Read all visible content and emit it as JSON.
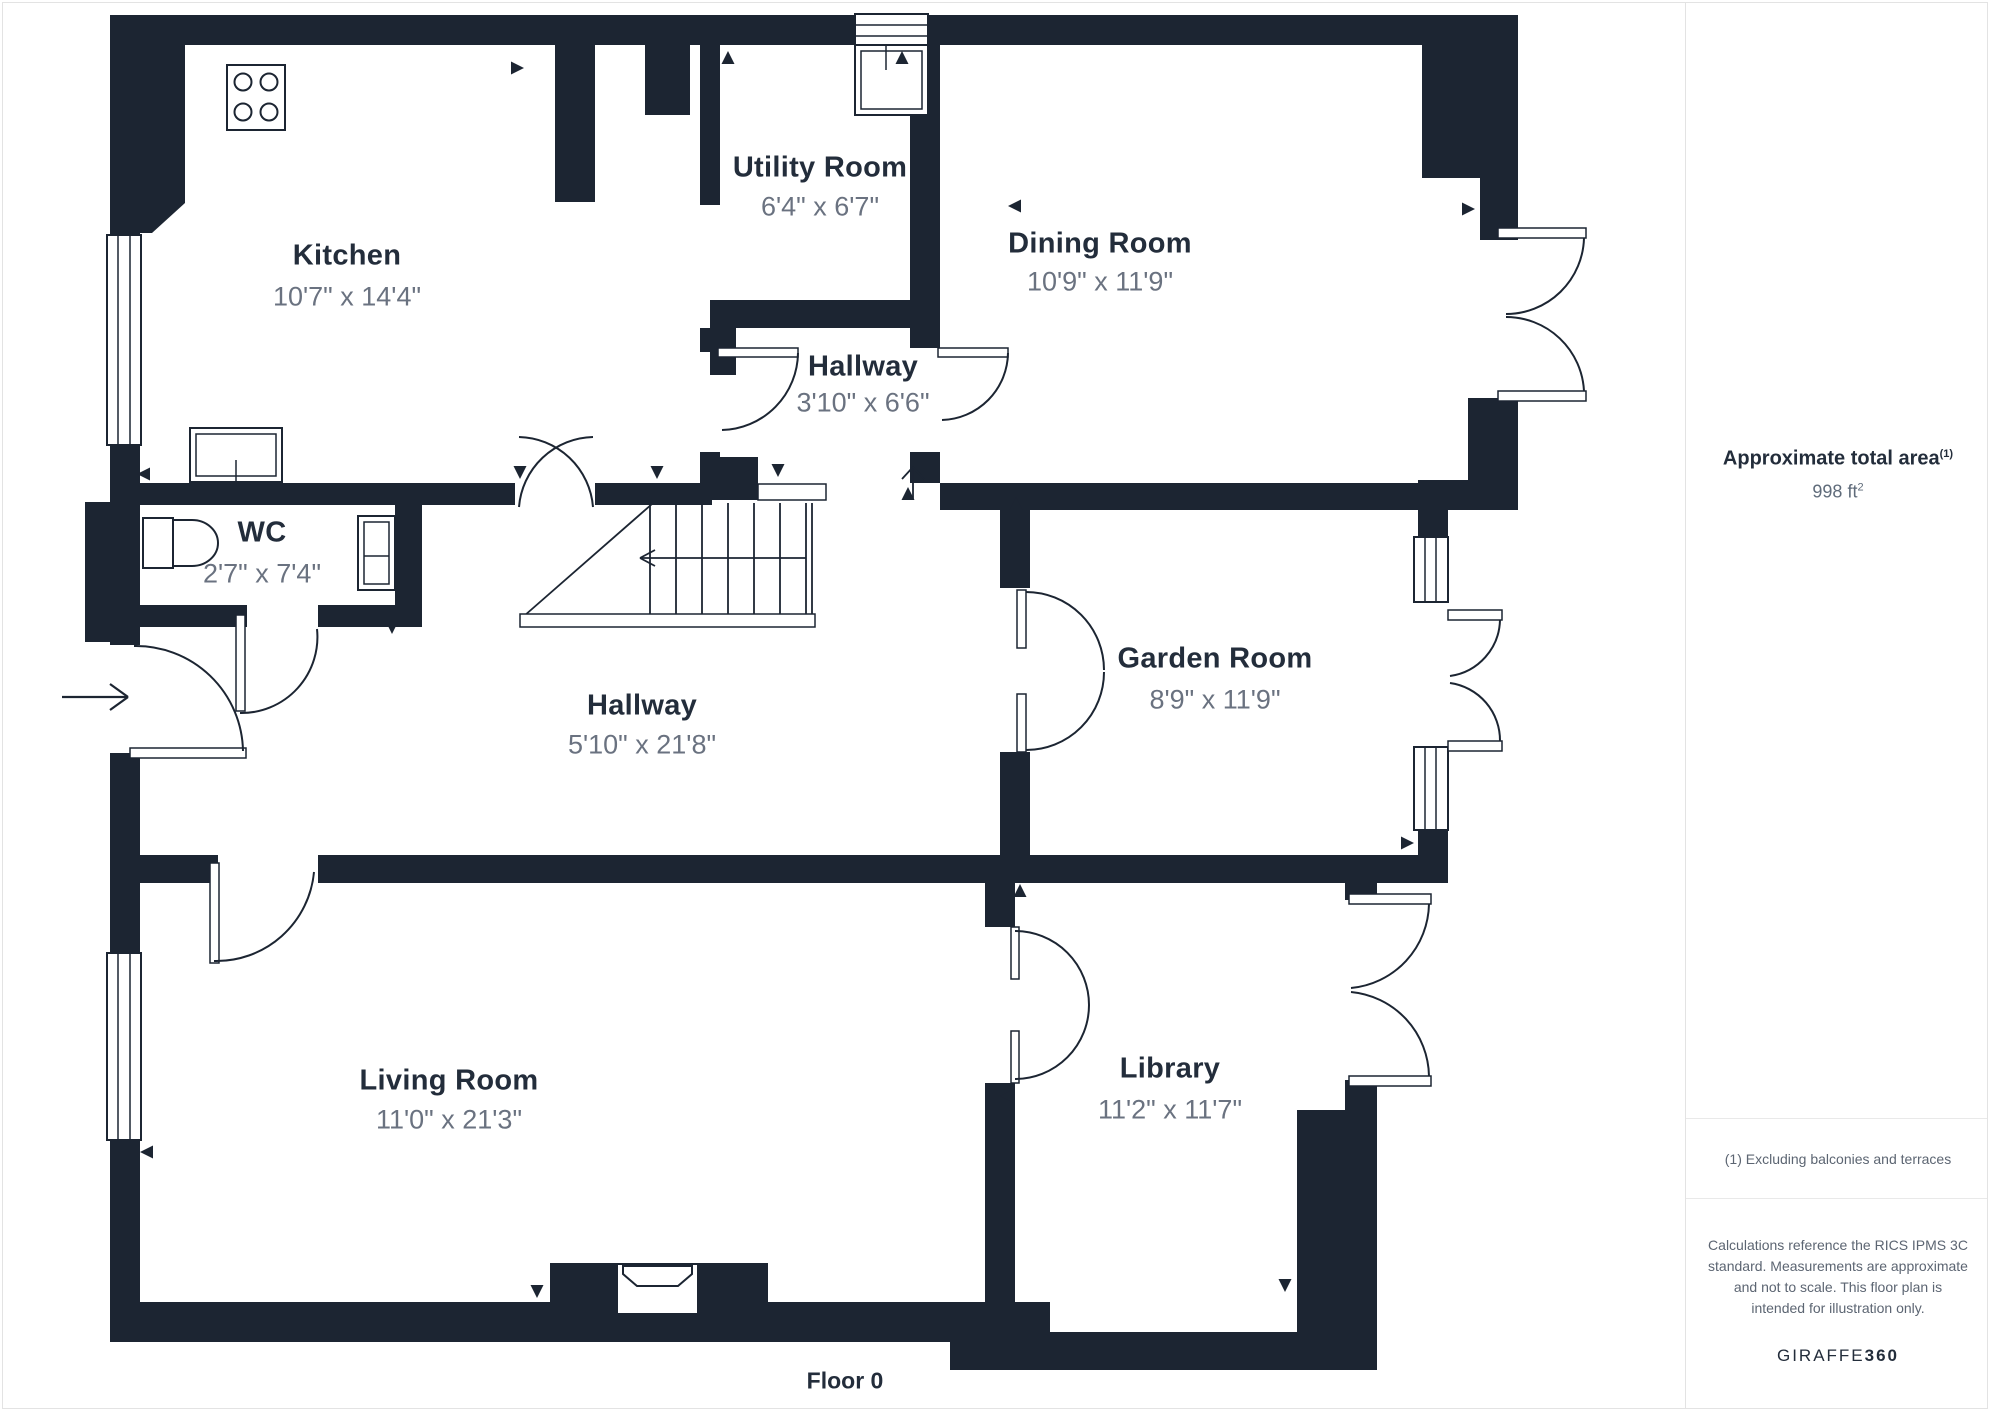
{
  "plan": {
    "floor_label": "Floor 0",
    "rooms": [
      {
        "name": "Kitchen",
        "dimensions": "10'7\" x 14'4\""
      },
      {
        "name": "Utility Room",
        "dimensions": "6'4\" x 6'7\""
      },
      {
        "name": "Dining Room",
        "dimensions": "10'9\" x 11'9\""
      },
      {
        "name": "Hallway",
        "dimensions": "3'10\" x 6'6\""
      },
      {
        "name": "WC",
        "dimensions": "2'7\" x 7'4\""
      },
      {
        "name": "Hallway",
        "dimensions": "5'10\" x 21'8\""
      },
      {
        "name": "Garden Room",
        "dimensions": "8'9\" x 11'9\""
      },
      {
        "name": "Living Room",
        "dimensions": "11'0\" x 21'3\""
      },
      {
        "name": "Library",
        "dimensions": "11'2\" x 11'7\""
      }
    ]
  },
  "sidebar": {
    "area_title": "Approximate total area",
    "area_title_sup": "(1)",
    "area_value": "998 ft",
    "area_value_sup": "2",
    "footnote": "(1) Excluding balconies and terraces",
    "disclaimer": "Calculations reference the RICS IPMS 3C standard. Measurements are approximate and not to scale. This floor plan is intended for illustration only.",
    "brand_regular": "GIRAFFE",
    "brand_bold": "360"
  },
  "colors": {
    "wall": "#1c2532",
    "room_name": "#232d3b",
    "dims_text": "#6a7280",
    "divider": "#e3e3e3"
  }
}
